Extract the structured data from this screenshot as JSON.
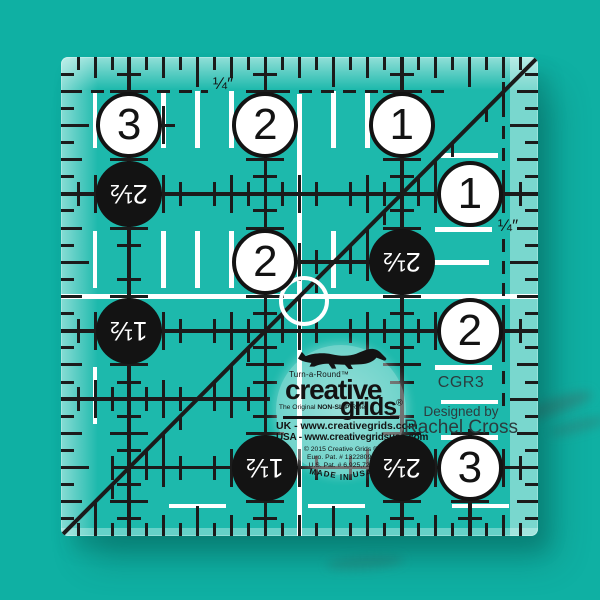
{
  "scene": {
    "type": "product photo of a square quilting ruler",
    "background_color": "#0fb0a3"
  },
  "ruler": {
    "model_number": "CGR3",
    "designer_label": "Designed by",
    "designer_name": "Rachel Cross",
    "quarter_label": "¼″",
    "colors": {
      "body": "#1db9ac",
      "marking_black": "#1b1b1b",
      "marking_white": "#ffffff",
      "circle_white_fill": "#ffffff",
      "circle_black_fill": "#131313"
    },
    "circles": [
      {
        "value": "3",
        "col": 0.5,
        "row": 0.5,
        "style": "white"
      },
      {
        "value": "2",
        "col": 1.5,
        "row": 0.5,
        "style": "white"
      },
      {
        "value": "1",
        "col": 2.5,
        "row": 0.5,
        "style": "white"
      },
      {
        "value": "2½",
        "col": 0.5,
        "row": 1.0,
        "style": "black"
      },
      {
        "value": "1",
        "col": 3.0,
        "row": 1.0,
        "style": "white"
      },
      {
        "value": "2",
        "col": 1.5,
        "row": 1.5,
        "style": "white"
      },
      {
        "value": "2½",
        "col": 2.5,
        "row": 1.5,
        "style": "black"
      },
      {
        "value": "1½",
        "col": 0.5,
        "row": 2.0,
        "style": "black"
      },
      {
        "value": "2",
        "col": 3.0,
        "row": 2.0,
        "style": "white"
      },
      {
        "value": "1½",
        "col": 1.5,
        "row": 3.0,
        "style": "black"
      },
      {
        "value": "2½",
        "col": 2.5,
        "row": 3.0,
        "style": "black"
      },
      {
        "value": "3",
        "col": 3.0,
        "row": 3.0,
        "style": "white"
      }
    ],
    "logo": {
      "tagline_top": "Turn-a-Round™",
      "brand_line1": "creative",
      "brand_line2": "grids",
      "registered_mark": "®",
      "original_prefix": "The Original ",
      "original_bold": "NON-SLIP",
      "original_suffix": " Ruler",
      "url_uk": "UK - www.creativegrids.com",
      "url_usa": "USA - www.creativegridsusa.com",
      "copyright": "© 2015 Creative Grids ®",
      "patent_euro": "Euro. Pat. # 13228098",
      "patent_us": "U.S. Pat. # 6,925,724",
      "made_word_1": "MADE",
      "made_word_2": "IN",
      "made_word_3": "USA"
    }
  }
}
